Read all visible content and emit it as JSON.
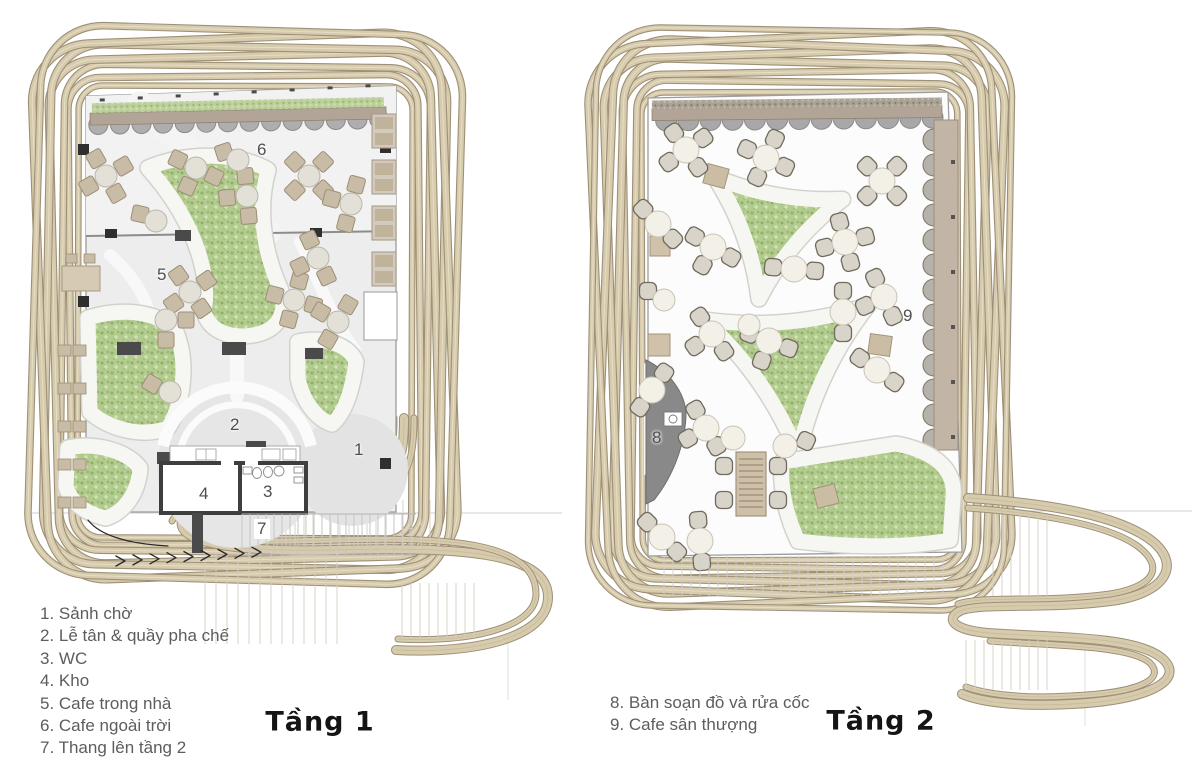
{
  "plans": [
    {
      "title": "Tầng 1",
      "markers": [
        "1",
        "2",
        "3",
        "4",
        "5",
        "6",
        "7"
      ]
    },
    {
      "title": "Tầng 2",
      "markers": [
        "8",
        "9"
      ]
    }
  ],
  "legends": [
    {
      "items": [
        "1. Sảnh chờ",
        "2. Lễ tân & quầy pha chế",
        "3. WC",
        "4. Kho",
        "5. Cafe trong nhà",
        "6. Cafe ngoài trời",
        "7. Thang lên tầng 2"
      ]
    },
    {
      "items": [
        "8. Bàn soạn đồ và rửa cốc",
        "9. Cafe sân thượng"
      ]
    }
  ],
  "colors": {
    "ribbon": "#d7cbae",
    "ribbon_edge": "#9e9077",
    "ribbon_hi": "#e8dfc6",
    "ribbon_mid": "#c9bc9d",
    "floor": "#ededed",
    "floor_light": "#f2f2f2",
    "floor2": "#fcfcfc",
    "wall": "#3e3e3e",
    "wall_thin": "#9c9c9c",
    "green_base": "#b2cb8e",
    "green_dark": "#8fae67",
    "green_lite": "#d2e2b4",
    "green_edge": "#7a8a5e",
    "band_white": "#f6f6f3",
    "band_edge": "#d2d2cd",
    "awning_beam": "#b2a597",
    "scallop": "#aeaeae",
    "scallop_edge": "#8b8b8b",
    "chair1": "#c9bca6",
    "chair1_s": "#9c8f76",
    "table1": "#e3e0d8",
    "table1_s": "#bab6ab",
    "chair2": "#d8d4c9",
    "chair2_s": "#716b5e",
    "table2": "#f3f0e8",
    "table2_s": "#c7c3b6",
    "gray_zone": "#e6e6e6",
    "walk_white": "#f8f8f8",
    "wedge": "#898989",
    "strip2": "#c2b5a5",
    "seat2": "#b6b2aa",
    "seat2_s": "#807b72",
    "bench": "#4a4a4a",
    "hatch": "#c9c9c9",
    "ink": "#2a2a2a",
    "fixture": "#8a8a8a",
    "counter_edge": "#a5a5a5"
  }
}
